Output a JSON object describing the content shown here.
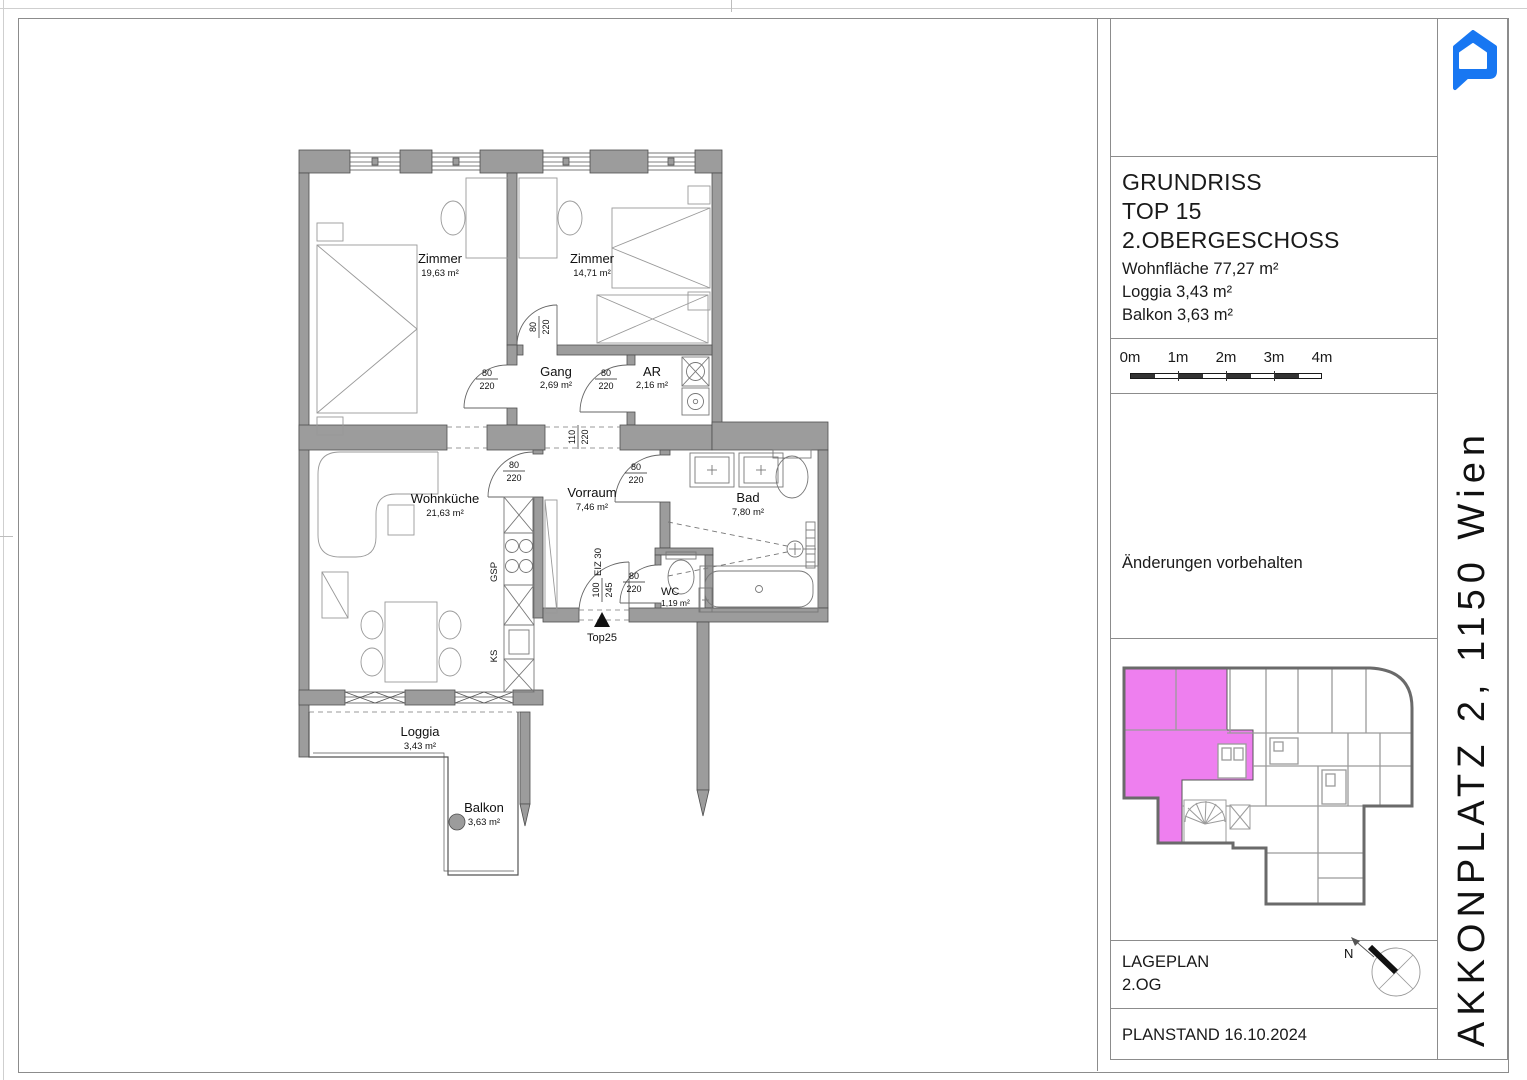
{
  "document": {
    "address_vertical": "AKKONPLATZ 2, 1150 Wien",
    "logo_color": "#1877F2"
  },
  "title_block": {
    "title": "GRUNDRISS",
    "unit": "TOP 15",
    "floor": "2.OBERGESCHOSS",
    "living_area": "Wohnfläche 77,27 m²",
    "loggia_area": "Loggia 3,43 m²",
    "balcony_area": "Balkon 3,63 m²"
  },
  "scale_bar": {
    "ticks": [
      "0m",
      "1m",
      "2m",
      "3m",
      "4m"
    ]
  },
  "disclaimer": "Änderungen vorbehalten",
  "site_plan": {
    "label": "LAGEPLAN",
    "floor": "2.OG",
    "north": "N",
    "highlight_color": "#EE7FEF"
  },
  "plan_status": "PLANSTAND 16.10.2024",
  "floor_plan": {
    "rooms": [
      {
        "name": "Zimmer",
        "area": "19,63 m²"
      },
      {
        "name": "Zimmer",
        "area": "14,71 m²"
      },
      {
        "name": "Gang",
        "area": "2,69 m²"
      },
      {
        "name": "AR",
        "area": "2,16 m²"
      },
      {
        "name": "Wohnküche",
        "area": "21,63 m²"
      },
      {
        "name": "Vorraum",
        "area": "7,46 m²"
      },
      {
        "name": "Bad",
        "area": "7,80 m²"
      },
      {
        "name": "WC",
        "area": "1,19 m²"
      },
      {
        "name": "Loggia",
        "area": "3,43 m²"
      },
      {
        "name": "Balkon",
        "area": "3,63 m²"
      }
    ],
    "dims": {
      "d80": "80",
      "d110": "110",
      "d100": "100",
      "d220": "220",
      "d245": "245"
    },
    "labels": {
      "gsp": "GSP",
      "ks": "KS",
      "eiz": "EIZ 30",
      "entry": "Top25"
    },
    "wall_color": "#9C9C9C"
  }
}
